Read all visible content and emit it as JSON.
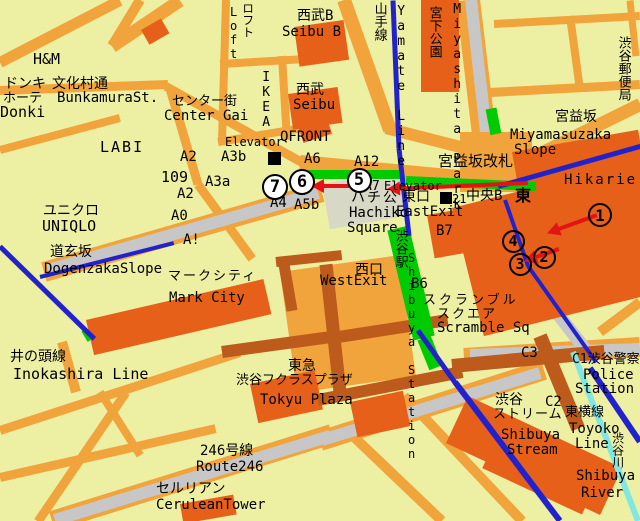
{
  "canvas": {
    "w": 640,
    "h": 521
  },
  "colors": {
    "bg": "#EDEFA3",
    "road": "#F1A33C",
    "bldg": "#E7601A",
    "brown": "#BD5B1C",
    "gray": "#C7C7C7",
    "plaza": "#D8D8C6",
    "blue": "#2222CC",
    "green": "#00CB00",
    "cyan": "#82E6E2",
    "red": "#E51414",
    "text": "#000000"
  },
  "roads": [
    [
      0,
      62,
      120,
      0,
      11
    ],
    [
      112,
      46,
      140,
      0,
      10
    ],
    [
      112,
      46,
      180,
      0,
      13
    ],
    [
      0,
      90,
      168,
      84,
      9
    ],
    [
      166,
      86,
      302,
      162,
      9
    ],
    [
      170,
      88,
      198,
      184,
      9
    ],
    [
      198,
      184,
      252,
      258,
      9
    ],
    [
      0,
      150,
      120,
      118,
      8
    ],
    [
      226,
      0,
      222,
      142,
      8
    ],
    [
      282,
      56,
      287,
      140,
      8
    ],
    [
      220,
      64,
      340,
      57,
      8
    ],
    [
      218,
      142,
      315,
      126,
      8
    ],
    [
      344,
      0,
      390,
      130,
      14
    ],
    [
      386,
      128,
      472,
      150,
      12
    ],
    [
      300,
      163,
      480,
      180,
      16
    ],
    [
      468,
      0,
      484,
      134,
      24
    ],
    [
      494,
      24,
      640,
      16,
      8
    ],
    [
      490,
      92,
      640,
      84,
      9
    ],
    [
      570,
      16,
      580,
      90,
      8
    ],
    [
      630,
      0,
      636,
      56,
      7
    ],
    [
      478,
      184,
      640,
      104,
      13
    ],
    [
      0,
      430,
      240,
      352,
      9
    ],
    [
      38,
      521,
      126,
      392,
      9
    ],
    [
      0,
      477,
      216,
      428,
      9
    ],
    [
      100,
      392,
      140,
      455,
      8
    ],
    [
      355,
      438,
      442,
      521,
      10
    ],
    [
      600,
      332,
      640,
      302,
      10
    ],
    [
      404,
      396,
      522,
      521,
      10
    ],
    [
      62,
      342,
      76,
      392,
      10
    ],
    [
      52,
      521,
      332,
      434,
      20
    ],
    [
      320,
      441,
      544,
      370,
      20
    ],
    [
      464,
      358,
      640,
      347,
      20
    ],
    [
      44,
      272,
      322,
      192,
      20
    ]
  ],
  "gray_roads": [
    [
      48,
      270,
      318,
      193,
      12,
      "dogenzaka-road"
    ],
    [
      471,
      0,
      486,
      132,
      12,
      "meiji-dori-road"
    ],
    [
      55,
      520,
      330,
      436,
      12,
      "route246-road"
    ],
    [
      322,
      440,
      540,
      373,
      12,
      "route246-road"
    ],
    [
      470,
      355,
      640,
      349,
      12,
      "route246-road"
    ],
    [
      498,
      196,
      521,
      266,
      13,
      "station-east-road"
    ],
    [
      521,
      266,
      594,
      360,
      13,
      "station-east-road"
    ]
  ],
  "plazas": [
    [
      322,
      184,
      82,
      46,
      -10,
      "plaza",
      "hachiko-square-area"
    ],
    [
      460,
      132,
      72,
      60,
      0,
      "road",
      "miyamasuzaka-crossing"
    ]
  ],
  "buildings": [
    [
      294,
      27,
      50,
      40,
      -8,
      "bldg",
      "seibu-b-building"
    ],
    [
      288,
      94,
      50,
      36,
      -8,
      "bldg",
      "seibu-building"
    ],
    [
      297,
      123,
      30,
      21,
      -18,
      "bldg",
      "qfront-building"
    ],
    [
      421,
      0,
      38,
      92,
      0,
      "bldg",
      "miyashita-park-building"
    ],
    [
      141,
      30,
      23,
      17,
      -30,
      "bldg",
      "small-building"
    ],
    [
      512,
      152,
      128,
      92,
      -10,
      "bldg",
      "hikarie-building"
    ],
    [
      452,
      208,
      188,
      132,
      -14,
      "bldg",
      "scramble-square-building"
    ],
    [
      427,
      215,
      46,
      44,
      -10,
      "bldg",
      "b7-building"
    ],
    [
      86,
      320,
      182,
      36,
      -13,
      "bldg",
      "mark-city-building"
    ],
    [
      280,
      272,
      120,
      122,
      -8,
      "road",
      "station-complex-building"
    ],
    [
      250,
      384,
      66,
      40,
      -12,
      "bldg",
      "tokyu-plaza-building"
    ],
    [
      350,
      402,
      54,
      36,
      -12,
      "bldg",
      "building-along-246"
    ],
    [
      180,
      504,
      54,
      20,
      -10,
      "bldg",
      "cerulean-tower-building"
    ],
    [
      468,
      396,
      170,
      52,
      25,
      "bldg",
      "shibuya-stream-building"
    ],
    [
      500,
      430,
      110,
      42,
      25,
      "bldg",
      "shibuya-stream-building"
    ]
  ],
  "brown_roads": [
    [
      222,
      352,
      338,
      336,
      12
    ],
    [
      332,
      338,
      448,
      320,
      12
    ],
    [
      326,
      264,
      340,
      392,
      13
    ],
    [
      276,
      262,
      342,
      255,
      10
    ],
    [
      318,
      400,
      462,
      372,
      12
    ],
    [
      452,
      366,
      604,
      352,
      14
    ],
    [
      540,
      336,
      578,
      428,
      14
    ],
    [
      284,
      264,
      292,
      310,
      11
    ]
  ],
  "greens": [
    [
      308,
      174,
      400,
      174,
      9,
      "walkway"
    ],
    [
      406,
      180,
      536,
      186,
      9,
      "walkway"
    ],
    [
      398,
      228,
      424,
      338,
      22,
      "station-strip"
    ],
    [
      424,
      338,
      436,
      368,
      14,
      "station-strip"
    ],
    [
      491,
      108,
      496,
      134,
      11,
      "walkway"
    ],
    [
      84,
      330,
      90,
      340,
      6,
      "walkway"
    ]
  ],
  "rails": [
    [
      393,
      0,
      399,
      148,
      5,
      "blue",
      "yamate-line"
    ],
    [
      399,
      148,
      409,
      235,
      5,
      "blue",
      "yamate-line"
    ],
    [
      418,
      330,
      455,
      382,
      5,
      "blue",
      "rail-line"
    ],
    [
      455,
      382,
      560,
      521,
      6,
      "blue",
      "toyoko-line"
    ],
    [
      590,
      368,
      640,
      442,
      6,
      "blue",
      "rail-line"
    ],
    [
      505,
      200,
      528,
      266,
      4,
      "blue",
      "rail-line"
    ],
    [
      528,
      266,
      596,
      362,
      4,
      "blue",
      "rail-line"
    ],
    [
      40,
      277,
      174,
      243,
      4,
      "blue",
      "subway-line"
    ],
    [
      0,
      246,
      94,
      338,
      5,
      "blue",
      "inokashira-line"
    ],
    [
      498,
      186,
      640,
      146,
      5,
      "blue",
      "rail-line"
    ],
    [
      573,
      352,
      638,
      521,
      6,
      "cyan",
      "shibuya-river-line"
    ]
  ],
  "markers": [
    [
      268,
      152,
      13,
      "station-marker"
    ],
    [
      440,
      192,
      12,
      "station-marker"
    ]
  ],
  "arrows": [
    [
      528,
      183,
      388,
      189
    ],
    [
      350,
      186,
      312,
      186
    ],
    [
      597,
      215,
      548,
      233
    ],
    [
      559,
      249,
      525,
      261
    ]
  ],
  "circles": [
    {
      "n": "1",
      "x": 600,
      "y": 215,
      "d": 24,
      "f": "none"
    },
    {
      "n": "2",
      "x": 544,
      "y": 257,
      "d": 23,
      "f": "none"
    },
    {
      "n": "3",
      "x": 520,
      "y": 264,
      "d": 23,
      "f": "none"
    },
    {
      "n": "4",
      "x": 513,
      "y": 241,
      "d": 23,
      "f": "none"
    },
    {
      "n": "5",
      "x": 359,
      "y": 180,
      "d": 25,
      "f": "#FFFFFF"
    },
    {
      "n": "6",
      "x": 302,
      "y": 182,
      "d": 26,
      "f": "#FFFFFF"
    },
    {
      "n": "7",
      "x": 275,
      "y": 187,
      "d": 26,
      "f": "#FFFFFF"
    }
  ],
  "labels": [
    {
      "t": "H&M",
      "x": 33,
      "y": 52,
      "s": 15
    },
    {
      "t": "ドンキ",
      "x": 4,
      "y": 77,
      "s": 14
    },
    {
      "t": "文化村通",
      "x": 52,
      "y": 77,
      "s": 14
    },
    {
      "t": "ホーテ",
      "x": 3,
      "y": 92,
      "s": 13
    },
    {
      "t": "BunkamuraSt.",
      "x": 57,
      "y": 91,
      "s": 14
    },
    {
      "t": "センター街",
      "x": 172,
      "y": 95,
      "s": 13
    },
    {
      "t": "Donki",
      "x": 0,
      "y": 105,
      "s": 15
    },
    {
      "t": "Center Gai",
      "x": 164,
      "y": 109,
      "s": 14
    },
    {
      "t": "LABI",
      "x": 100,
      "y": 140,
      "s": 15,
      "ls": 2
    },
    {
      "t": "A2",
      "x": 180,
      "y": 150,
      "s": 14
    },
    {
      "t": "109",
      "x": 161,
      "y": 170,
      "s": 15
    },
    {
      "t": "A2",
      "x": 177,
      "y": 187,
      "s": 14
    },
    {
      "t": "A3a",
      "x": 205,
      "y": 175,
      "s": 14
    },
    {
      "t": "A0",
      "x": 171,
      "y": 209,
      "s": 14
    },
    {
      "t": "A!",
      "x": 183,
      "y": 233,
      "s": 14
    },
    {
      "t": "ユニクロ",
      "x": 43,
      "y": 204,
      "s": 14
    },
    {
      "t": "UNIQLO",
      "x": 42,
      "y": 219,
      "s": 15
    },
    {
      "t": "Elevator",
      "x": 225,
      "y": 136,
      "s": 12
    },
    {
      "t": "A3b",
      "x": 221,
      "y": 150,
      "s": 14
    },
    {
      "t": "QFRONT",
      "x": 280,
      "y": 130,
      "s": 14
    },
    {
      "t": "A6",
      "x": 304,
      "y": 152,
      "s": 14
    },
    {
      "t": "A12",
      "x": 354,
      "y": 155,
      "s": 14
    },
    {
      "t": "A7",
      "x": 364,
      "y": 180,
      "s": 13
    },
    {
      "t": "Elevator",
      "x": 384,
      "y": 180,
      "s": 12
    },
    {
      "t": "A4",
      "x": 270,
      "y": 196,
      "s": 14
    },
    {
      "t": "A5b",
      "x": 294,
      "y": 198,
      "s": 14
    },
    {
      "t": "ハチ公",
      "x": 351,
      "y": 191,
      "s": 14,
      "ls": 2
    },
    {
      "t": "Hachiko",
      "x": 349,
      "y": 206,
      "s": 14
    },
    {
      "t": "Square",
      "x": 347,
      "y": 221,
      "s": 14
    },
    {
      "t": "東口",
      "x": 402,
      "y": 190,
      "s": 14
    },
    {
      "t": "21",
      "x": 452,
      "y": 193,
      "s": 12
    },
    {
      "t": "中央B",
      "x": 466,
      "y": 189,
      "s": 14
    },
    {
      "t": "東",
      "x": 515,
      "y": 188,
      "s": 16,
      "b": 1
    },
    {
      "t": "EastExit",
      "x": 396,
      "y": 205,
      "s": 14
    },
    {
      "t": "B7",
      "x": 436,
      "y": 224,
      "s": 14
    },
    {
      "t": "宮益坂改札",
      "x": 438,
      "y": 154,
      "s": 15
    },
    {
      "t": "Miyamasuzaka",
      "x": 510,
      "y": 128,
      "s": 14
    },
    {
      "t": "Slope",
      "x": 514,
      "y": 143,
      "s": 14
    },
    {
      "t": "宮益坂",
      "x": 555,
      "y": 110,
      "s": 14
    },
    {
      "t": "Hikarie",
      "x": 564,
      "y": 173,
      "s": 14,
      "ls": 2
    },
    {
      "t": "渋谷郵便局",
      "x": 616,
      "y": 36,
      "s": 13,
      "v": 1
    },
    {
      "t": "Miyashita Park",
      "x": 450,
      "y": 2,
      "s": 13,
      "v": 1
    },
    {
      "t": "宮下公園",
      "x": 427,
      "y": 6,
      "s": 13,
      "v": 1
    },
    {
      "t": "山手線",
      "x": 372,
      "y": 2,
      "s": 13,
      "v": 1
    },
    {
      "t": "Yamate Line",
      "x": 394,
      "y": 4,
      "s": 13,
      "v": 1
    },
    {
      "t": "ロフト",
      "x": 241,
      "y": 2,
      "s": 12,
      "v": 1
    },
    {
      "t": "Loft",
      "x": 227,
      "y": 5,
      "s": 12,
      "v": 1
    },
    {
      "t": "西武B",
      "x": 297,
      "y": 9,
      "s": 14
    },
    {
      "t": "Seibu B",
      "x": 282,
      "y": 25,
      "s": 14
    },
    {
      "t": "IKEA",
      "x": 259,
      "y": 70,
      "s": 13,
      "v": 1
    },
    {
      "t": "西武",
      "x": 296,
      "y": 83,
      "s": 14
    },
    {
      "t": "Seibu",
      "x": 293,
      "y": 98,
      "s": 14
    },
    {
      "t": "道玄坂",
      "x": 50,
      "y": 245,
      "s": 14
    },
    {
      "t": "DogenzakaSlope",
      "x": 44,
      "y": 262,
      "s": 14
    },
    {
      "t": "マークシティ",
      "x": 168,
      "y": 270,
      "s": 13,
      "ls": 2
    },
    {
      "t": "Mark City",
      "x": 169,
      "y": 291,
      "s": 14
    },
    {
      "t": "井の頭線",
      "x": 10,
      "y": 350,
      "s": 14
    },
    {
      "t": "Inokashira Line",
      "x": 13,
      "y": 367,
      "s": 15
    },
    {
      "t": "西口",
      "x": 355,
      "y": 263,
      "s": 14
    },
    {
      "t": "WestExit",
      "x": 320,
      "y": 274,
      "s": 14
    },
    {
      "t": "B6",
      "x": 411,
      "y": 277,
      "s": 14
    },
    {
      "t": "渋谷駅",
      "x": 393,
      "y": 229,
      "s": 13,
      "v": 1
    },
    {
      "t": "Shibuya Station",
      "x": 405,
      "y": 251,
      "s": 12,
      "v": 1
    },
    {
      "t": "スクランブル",
      "x": 423,
      "y": 294,
      "s": 13,
      "ls": 3
    },
    {
      "t": "スクエア",
      "x": 437,
      "y": 308,
      "s": 13,
      "ls": 2
    },
    {
      "t": "Scramble Sq",
      "x": 437,
      "y": 321,
      "s": 14
    },
    {
      "t": "C3",
      "x": 521,
      "y": 346,
      "s": 14
    },
    {
      "t": "C1渋谷警察",
      "x": 572,
      "y": 353,
      "s": 13
    },
    {
      "t": "Police",
      "x": 583,
      "y": 368,
      "s": 14
    },
    {
      "t": "Station",
      "x": 575,
      "y": 382,
      "s": 14
    },
    {
      "t": "東急",
      "x": 288,
      "y": 359,
      "s": 14
    },
    {
      "t": "渋谷フクラスプラザ",
      "x": 236,
      "y": 374,
      "s": 13
    },
    {
      "t": "Tokyu Plaza",
      "x": 260,
      "y": 393,
      "s": 14
    },
    {
      "t": "246号線",
      "x": 200,
      "y": 444,
      "s": 14
    },
    {
      "t": "Route246",
      "x": 196,
      "y": 460,
      "s": 14
    },
    {
      "t": "セルリアン",
      "x": 156,
      "y": 482,
      "s": 14
    },
    {
      "t": "CeruleanTower",
      "x": 156,
      "y": 498,
      "s": 14
    },
    {
      "t": "渋谷",
      "x": 495,
      "y": 393,
      "s": 14
    },
    {
      "t": "C2",
      "x": 545,
      "y": 395,
      "s": 14
    },
    {
      "t": "ストリーム",
      "x": 493,
      "y": 408,
      "s": 13,
      "ls": 1
    },
    {
      "t": "Shibuya",
      "x": 501,
      "y": 428,
      "s": 14
    },
    {
      "t": "Stream",
      "x": 507,
      "y": 443,
      "s": 14
    },
    {
      "t": "東横線",
      "x": 565,
      "y": 406,
      "s": 13
    },
    {
      "t": "Toyoko",
      "x": 569,
      "y": 422,
      "s": 14
    },
    {
      "t": "Line",
      "x": 575,
      "y": 437,
      "s": 14
    },
    {
      "t": "渋谷川",
      "x": 611,
      "y": 432,
      "s": 12,
      "v": 1
    },
    {
      "t": "Shibuya",
      "x": 576,
      "y": 469,
      "s": 14
    },
    {
      "t": "River",
      "x": 581,
      "y": 486,
      "s": 14
    }
  ]
}
